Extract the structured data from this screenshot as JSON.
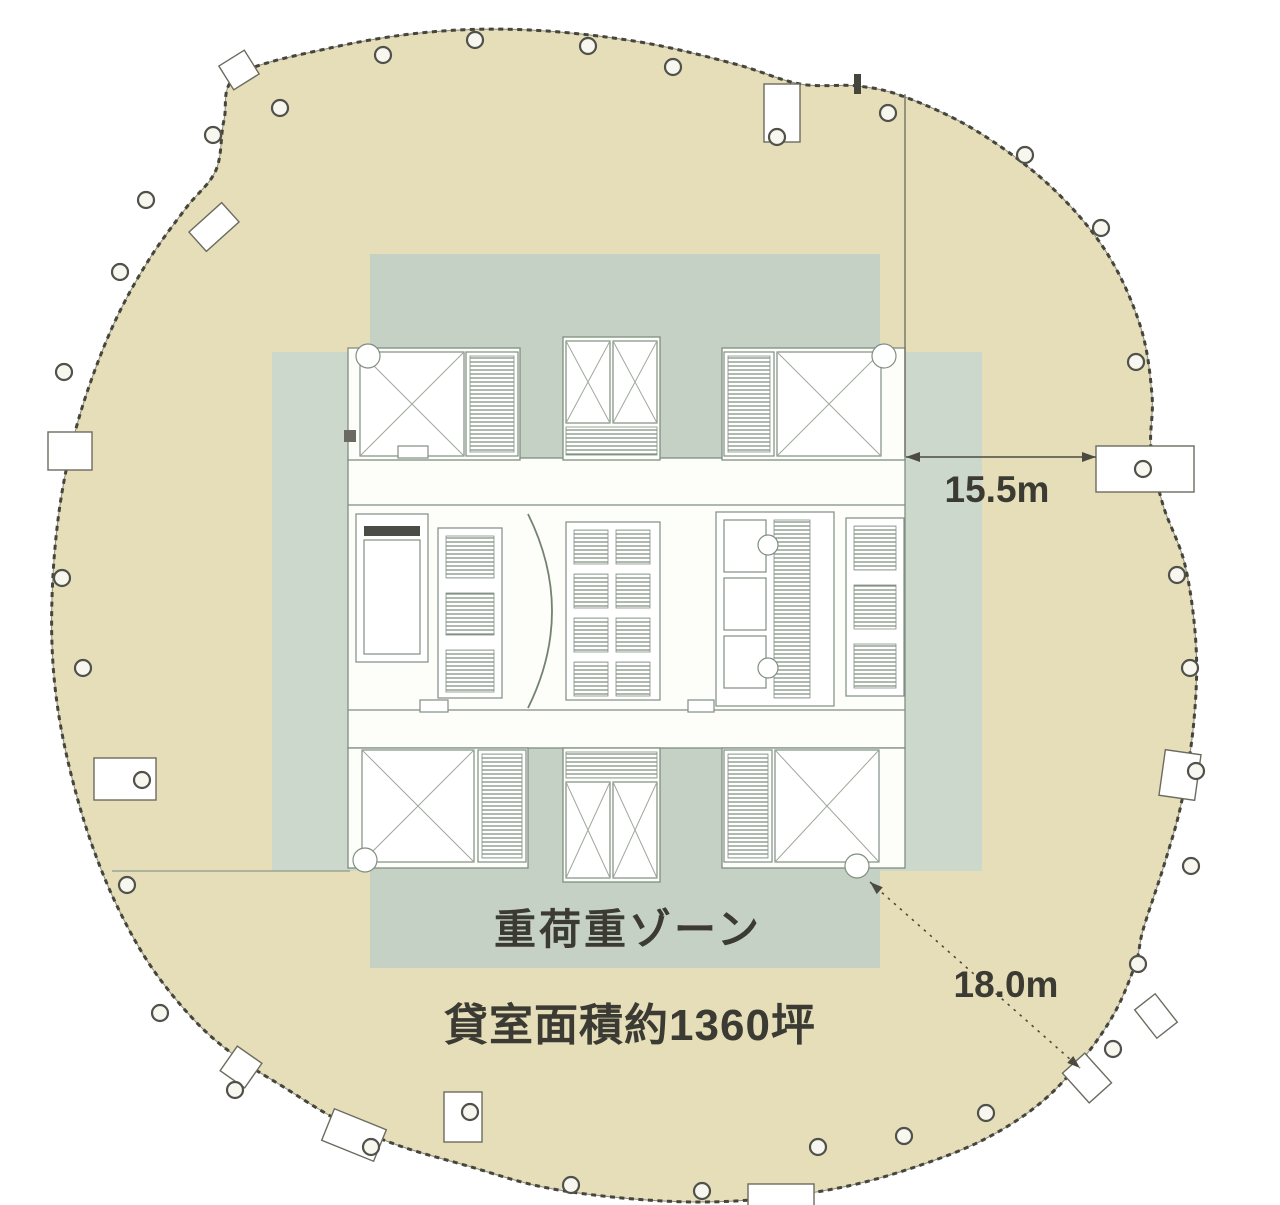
{
  "labels": {
    "heavy_load_zone": "重荷重ゾーン",
    "rental_area": "貸室面積約1360坪"
  },
  "dimensions": {
    "core_to_east_edge": "15.5m",
    "core_corner_to_edge": "18.0m"
  },
  "colors": {
    "floor_plate": "#E5DEB9",
    "zone_band_horizontal": "#CDD8CC",
    "zone_band_vertical": "#C5D1C5",
    "core_fill": "#FDFDFA",
    "outline": "#45453C",
    "dimension": "#4B4B40",
    "text": "#3B3B33"
  }
}
